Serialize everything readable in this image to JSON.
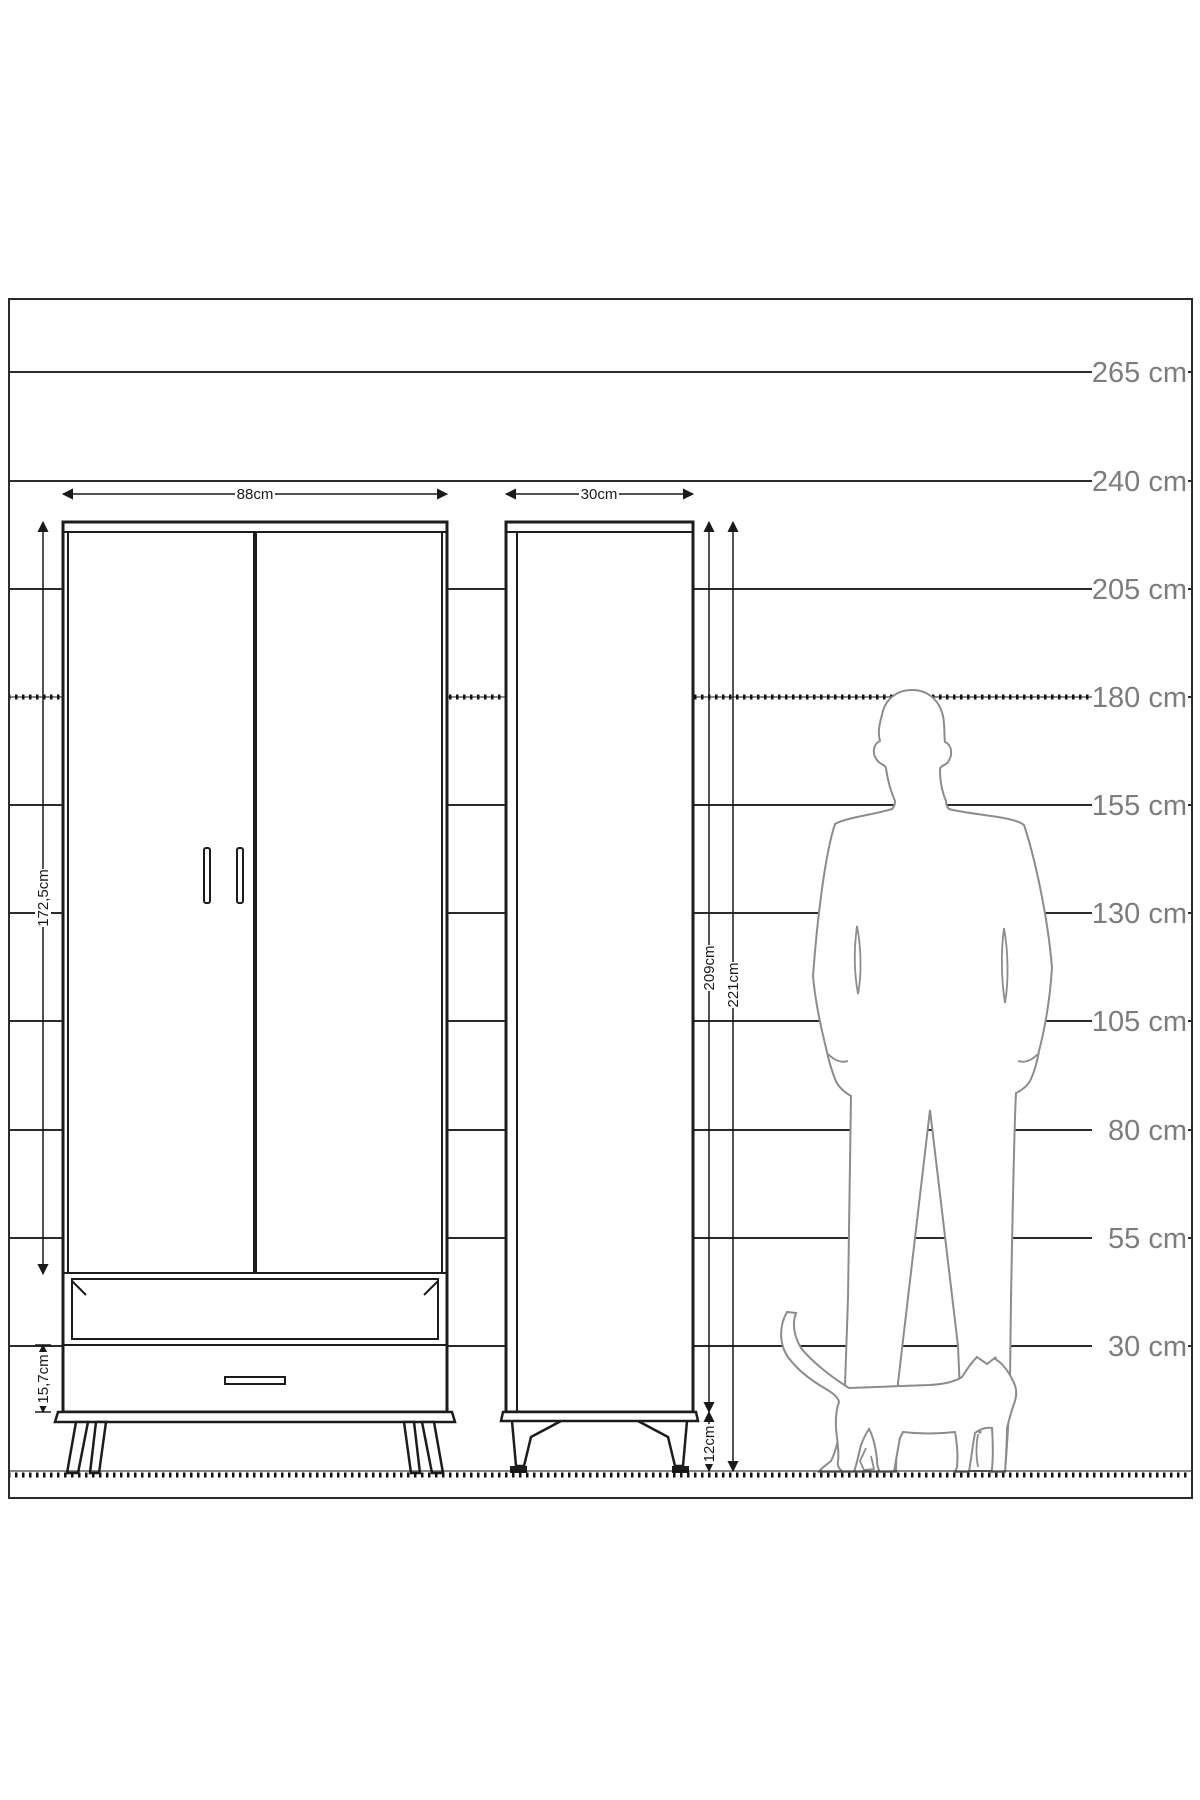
{
  "diagram": {
    "scale_labels": [
      "265 cm",
      "240 cm",
      "205 cm",
      "180 cm",
      "155 cm",
      "130 cm",
      "105 cm",
      "80 cm",
      "55 cm",
      "30 cm"
    ],
    "wardrobe": {
      "width_label": "88cm",
      "door_height_label": "172,5cm",
      "drawer_height_label": "15,7cm"
    },
    "cabinet": {
      "width_label": "30cm",
      "body_height_label": "209cm",
      "total_height_label": "221cm",
      "leg_height_label": "12cm"
    },
    "colors": {
      "background": "#ffffff",
      "furniture_outline": "#1c1c1c",
      "scale_line": "#2b2b2b",
      "scale_label_gray": "#7d7d7d",
      "figure_gray": "#8c8c8c"
    }
  }
}
